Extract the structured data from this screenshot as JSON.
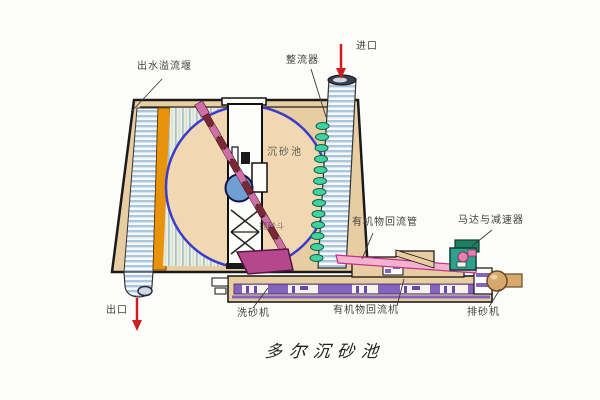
{
  "diagram": {
    "title": "多尔沉砂池",
    "labels": {
      "effluent_weir": "出水溢流堰",
      "flow_straightener": "整流器",
      "inlet": "进口",
      "grit_chamber": "沉砂池",
      "bucket_elevator": "提砂斗",
      "organic_return_pipe": "有机物回流管",
      "motor_reducer": "马达与减速器",
      "outlet": "出口",
      "sand_washer": "洗砂机",
      "organic_return_machine": "有机物回流机",
      "sand_discharger": "排砂机"
    },
    "colors": {
      "tank_fill": "#e9cda2",
      "pool_fill": "#f2d8b2",
      "pool_outline": "#3b3bcc",
      "weir_orange": "#e8930c",
      "stripe_blue": "#aac6dd",
      "nozzle_green": "#3ed3a0",
      "chain_pink": "#cf6fa8",
      "chain_dark": "#7a2737",
      "wheel_blue": "#6f9fd0",
      "scraper_magenta": "#b5488d",
      "conveyor_purple": "#8463bd",
      "motor_teal": "#2fa08b",
      "ball_tan": "#d8a96f",
      "arrow_red": "#cc2020"
    }
  }
}
